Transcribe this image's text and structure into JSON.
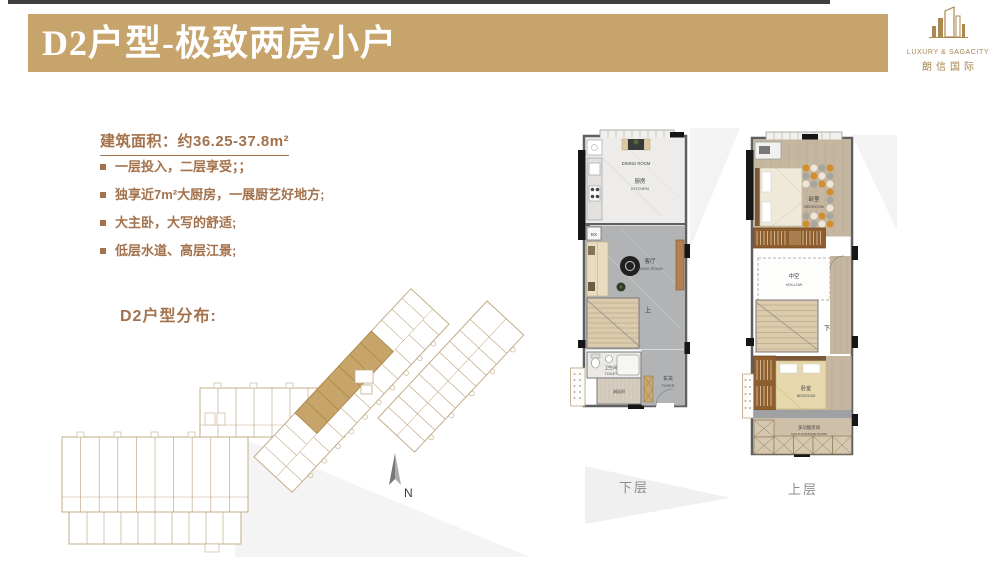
{
  "header": {
    "title": "D2户型-极致两房小户"
  },
  "logo": {
    "icon": "building-skyline-icon",
    "line1": "LUXURY & SAGACITY",
    "line2": "朗信国际"
  },
  "info": {
    "area_heading": "建筑面积：约36.25-37.8m²",
    "bullets": [
      "一层投入，二层享受；；",
      "独享近7m²大厨房，一展厨艺好地方;",
      "大主卧，大写的舒适;",
      "低层水道、高层江景;"
    ]
  },
  "distribution": {
    "label": "D2户型分布:",
    "north": "N"
  },
  "floorplans": {
    "lower": {
      "caption": "下层",
      "dining_en": "DINING ROOM",
      "kitchen_zh": "厨房",
      "kitchen_en": "KITCHEN",
      "bx": "BX",
      "living_zh": "客厅",
      "living_en": "LIVING ROOM",
      "stairs_up": "上",
      "toilet_zh": "卫生间",
      "toilet_en": "TOILET",
      "shower_zh": "淋浴间",
      "foyer_zh": "玄关",
      "foyer_en": "FOYER"
    },
    "upper": {
      "caption": "上层",
      "bedroom1_zh": "卧室",
      "bedroom1_en": "BEDROOM",
      "hollow_zh": "中空",
      "hollow_en": "HOLLOW",
      "stairs_down": "下",
      "bedroom2_zh": "卧室",
      "bedroom2_en": "BEDROOM",
      "multi_zh": "多功能房间",
      "multi_en": "MULTI-PURPOSE ROOM"
    }
  },
  "colors": {
    "accent_gold": "#c7a46c",
    "text_brown": "#a3724c",
    "plan_line_tan": "#c3ac88",
    "unit_highlight": "#c7a469",
    "caption_gray": "#8c8c8c",
    "top_bar": "#3f3f3f"
  }
}
